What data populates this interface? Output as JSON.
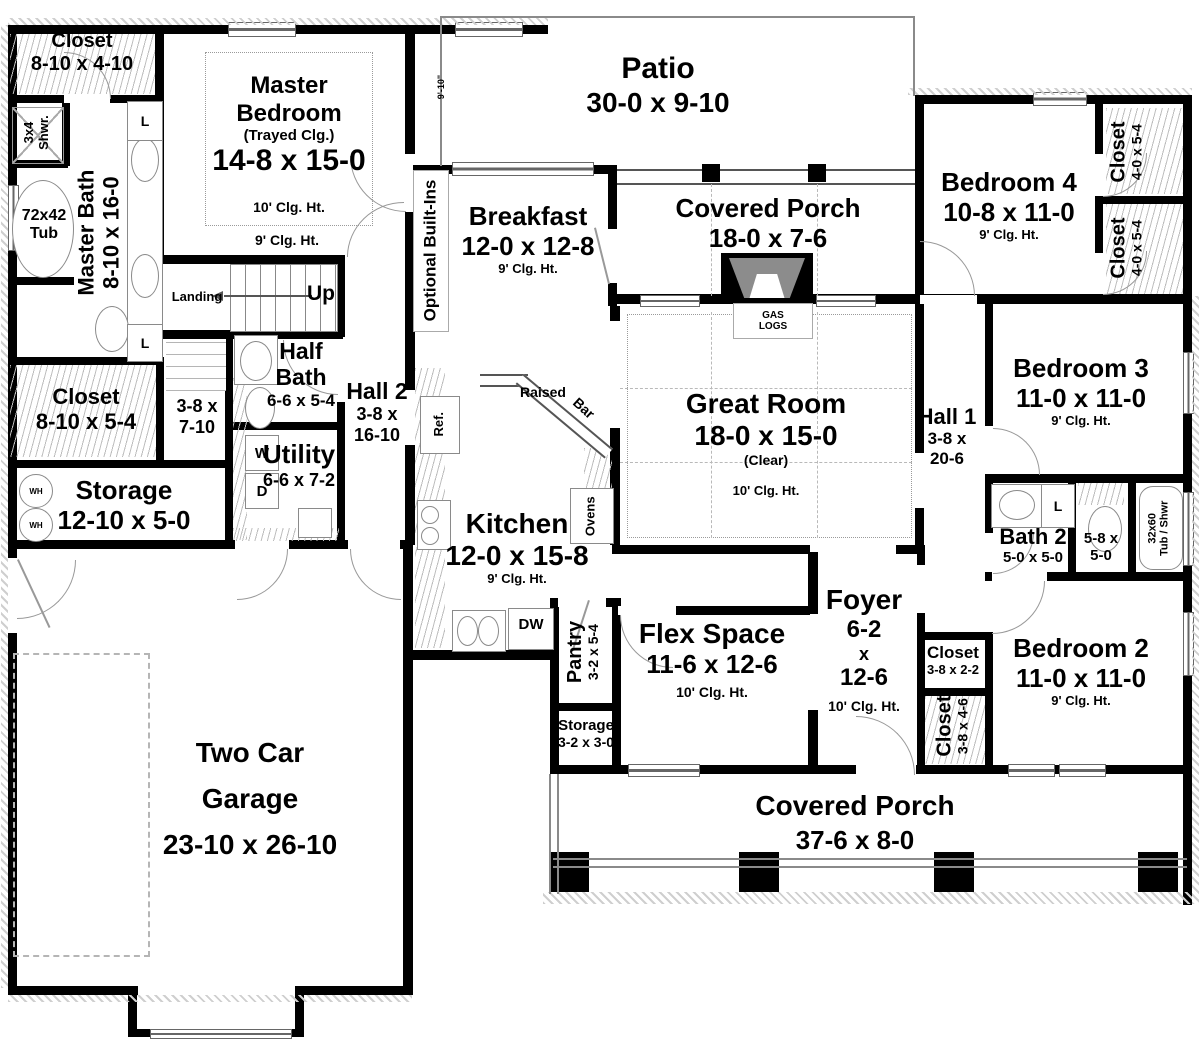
{
  "rooms": {
    "closet_master_top": {
      "name": "Closet",
      "dims": "8-10 x 4-10"
    },
    "shower_master": {
      "size": "3x4",
      "label": "Shwr."
    },
    "tub_master": {
      "size": "72x42",
      "label": "Tub"
    },
    "master_bath": {
      "name": "Master Bath",
      "dims": "8-10 x 16-0"
    },
    "master_bedroom": {
      "name": "Master Bedroom",
      "note": "(Trayed Clg.)",
      "dims": "14-8 x 15-0",
      "ceiling": "10' Clg. Ht.",
      "ceiling_outer": "9' Clg. Ht."
    },
    "stairs": {
      "landing": "Landing",
      "up": "Up"
    },
    "hall_lower": {
      "dims_line1": "3-8 x",
      "dims_line2": "7-10"
    },
    "closet_master_lower": {
      "name": "Closet",
      "dims": "8-10 x 5-4"
    },
    "storage_rear": {
      "name": "Storage",
      "dims": "12-10 x 5-0"
    },
    "half_bath": {
      "name": "Half Bath",
      "dims": "6-6 x 5-4"
    },
    "utility": {
      "name": "Utility",
      "dims": "6-6 x 7-2"
    },
    "hall2": {
      "name": "Hall 2",
      "dims_line1": "3-8 x",
      "dims_line2": "16-10"
    },
    "patio": {
      "name": "Patio",
      "dims": "30-0 x 9-10",
      "depth_dim": "9'-10\""
    },
    "breakfast": {
      "name": "Breakfast",
      "dims": "12-0 x 12-8",
      "ceiling": "9' Clg. Ht."
    },
    "optional_builtins": {
      "label": "Optional Built-Ins"
    },
    "covered_porch_rear": {
      "name": "Covered Porch",
      "dims": "18-0 x 7-6"
    },
    "fireplace": {
      "line1": "GAS",
      "line2": "LOGS"
    },
    "great_room": {
      "name": "Great Room",
      "dims": "18-0 x 15-0",
      "note": "(Clear)",
      "ceiling": "10' Clg. Ht."
    },
    "kitchen": {
      "name": "Kitchen",
      "dims": "12-0 x 15-8",
      "ceiling": "9' Clg. Ht."
    },
    "pantry": {
      "name": "Pantry",
      "dims": "3-2 x 5-4"
    },
    "storage_front": {
      "name": "Storage",
      "dims": "3-2 x 3-0"
    },
    "flex_space": {
      "name": "Flex Space",
      "dims": "11-6 x 12-6",
      "ceiling": "10' Clg. Ht."
    },
    "foyer": {
      "name": "Foyer",
      "dims_line1": "6-2",
      "dims_line2": "x",
      "dims_line3": "12-6",
      "ceiling": "10' Clg. Ht."
    },
    "hall1": {
      "name": "Hall 1",
      "dims_line1": "3-8 x",
      "dims_line2": "20-6"
    },
    "bedroom4": {
      "name": "Bedroom 4",
      "dims": "10-8 x 11-0",
      "ceiling": "9' Clg. Ht."
    },
    "closet_bed4_upper": {
      "name": "Closet",
      "dims": "4-0 x 5-4"
    },
    "closet_bed4_lower": {
      "name": "Closet",
      "dims": "4-0 x 5-4"
    },
    "bedroom3": {
      "name": "Bedroom 3",
      "dims": "11-0 x 11-0",
      "ceiling": "9' Clg. Ht."
    },
    "bath2": {
      "name": "Bath 2",
      "dims": "5-0 x 5-0"
    },
    "water_closet": {
      "dims_line1": "5-8 x",
      "dims_line2": "5-0"
    },
    "tub_shower2": {
      "size": "32x60",
      "label": "Tub / Shwr"
    },
    "bedroom2": {
      "name": "Bedroom 2",
      "dims": "11-0 x 11-0",
      "ceiling": "9' Clg. Ht."
    },
    "closet_foyer": {
      "name": "Closet",
      "dims": "3-8 x 2-2"
    },
    "closet_bed2": {
      "name": "Closet",
      "dims": "3-8 x 4-6"
    },
    "garage": {
      "name_line1": "Two Car",
      "name_line2": "Garage",
      "dims": "23-10 x 26-10"
    },
    "covered_porch_front": {
      "name": "Covered Porch",
      "dims": "37-6 x 8-0"
    }
  },
  "appliances": {
    "refrigerator": "Ref.",
    "raised_bar_line1": "Raised",
    "raised_bar_line2": "Bar",
    "ovens": "Ovens",
    "dishwasher": "DW",
    "washer": "W",
    "dryer": "D",
    "water_heater": "WH",
    "linen": "L"
  },
  "colors": {
    "wall": "#000000",
    "hatch": "#bdbdbd",
    "fixture_line": "#8a8a8a",
    "fireplace_fill": "#8c8c8c"
  }
}
